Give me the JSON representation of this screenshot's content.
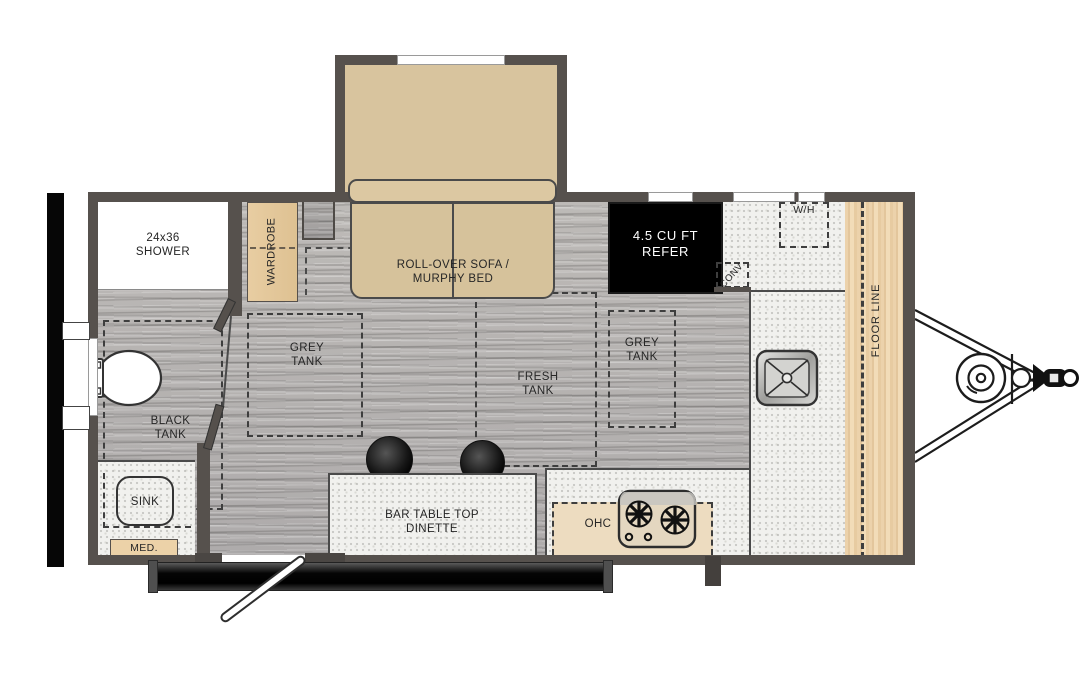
{
  "floorplan": {
    "type": "travel-trailer-floor-plan",
    "labels": {
      "shower": "24x36 SHOWER",
      "wardrobe": "WARDROBE",
      "murphy_bed": "ROLL-OVER SOFA / MURPHY BED",
      "refrigerator": "4.5 CU FT REFER",
      "water_heater": "W/H",
      "convection": "CONV",
      "floor_line": "FLOOR LINE",
      "grey_tank_left": "GREY TANK",
      "grey_tank_right": "GREY TANK",
      "fresh_tank": "FRESH TANK",
      "black_tank": "BLACK TANK",
      "bath_sink": "SINK",
      "medicine_cabinet": "MED.",
      "dinette": "BAR TABLE TOP DINETTE",
      "overhead_cabinet": "OHC"
    },
    "colors": {
      "wall": "#56514d",
      "cabinet_tan": "#e5c99e",
      "bed_tan": "#d6c29b",
      "counter_grey": "#f1f1ee",
      "floor_grey": "#b5b2af",
      "refrigerator_bg": "#000000",
      "refrigerator_text": "#ffffff",
      "frame_black": "#0a0a0a"
    },
    "fixtures": [
      "toilet",
      "bath-sink",
      "kitchen-sink",
      "cooktop-2-burner",
      "bar-stool",
      "bar-stool",
      "murphy-bed-sofa",
      "entry-door-open",
      "shower-door",
      "bath-door",
      "a-frame-tongue",
      "lp-tank",
      "hitch-coupler",
      "water-heater",
      "convection-oven"
    ]
  }
}
